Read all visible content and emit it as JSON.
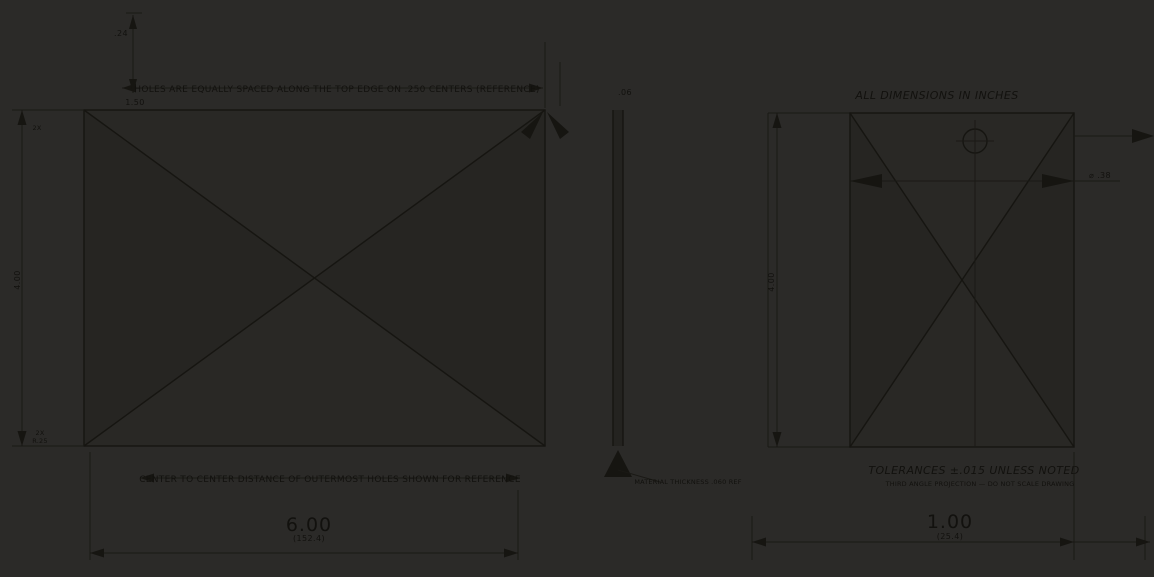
{
  "colors": {
    "background": "#2b2a28",
    "ink": "#161511",
    "text": "#12110e",
    "shade_light": "#292825",
    "shade_dark": "#262522"
  },
  "labels": {
    "top_note": "HOLES ARE EQUALLY SPACED ALONG THE TOP EDGE ON .250 CENTERS (REFERENCE)",
    "top_gap_dim": ".24",
    "top_offset_dim": "1.50",
    "corner_note_top": "2X",
    "height_dim_left": "4.00",
    "corner_note_bottom_1": "2X",
    "corner_note_bottom_2": "R.25",
    "bottom_note": "CENTER TO CENTER DISTANCE OF OUTERMOST HOLES SHOWN FOR REFERENCE",
    "width_dim_primary": "6.00",
    "width_dim_secondary": "(152.4)",
    "thickness_dim": ".06",
    "middle_bottom_note": "MATERIAL THICKNESS .060 REF",
    "height_dim_right": "4.00",
    "right_top_note": "ALL DIMENSIONS IN INCHES",
    "hole_dim": "⌀ .38",
    "right_bottom_note_1": "TOLERANCES ±.015 UNLESS NOTED",
    "right_bottom_note_2": "THIRD ANGLE PROJECTION — DO NOT SCALE DRAWING",
    "side_width_dim_primary": "1.00",
    "side_width_dim_secondary": "(25.4)"
  }
}
